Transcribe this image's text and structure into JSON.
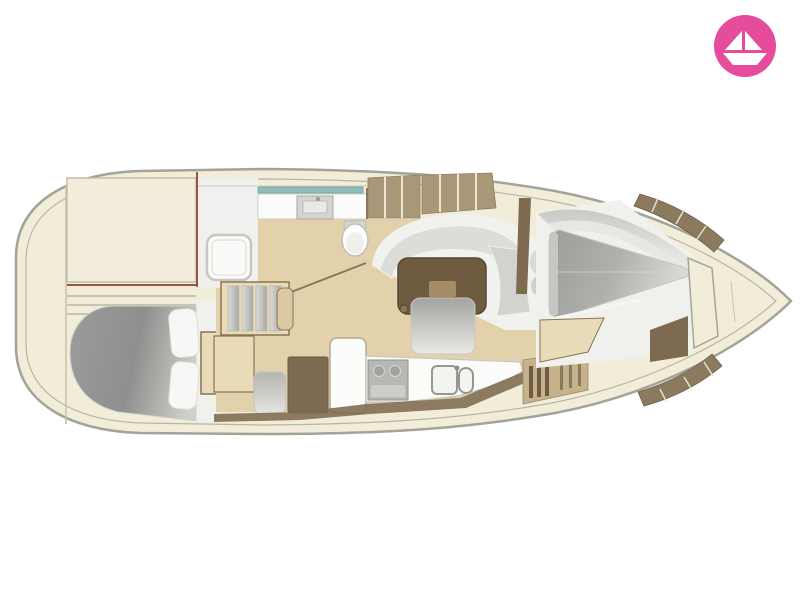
{
  "logo": {
    "icon": "paper-boat-icon",
    "background_color": "#e64c9c",
    "icon_color": "#ffffff"
  },
  "floor_plan": {
    "type": "sailboat-interior-top-view",
    "orientation": {
      "bow": "right",
      "stern": "left"
    },
    "areas": [
      "stern-deck",
      "aft-cabin-berth",
      "head-with-shower",
      "toilet",
      "companionway-steps",
      "salon-settee",
      "salon-table",
      "nav-station",
      "galley",
      "v-berth-cabin",
      "forepeak-anchor-locker"
    ],
    "colors": {
      "hull_fill": "#f2edd9",
      "hull_stroke": "#a3a39a",
      "deck_line": "#b9b5a3",
      "floor_beige": "#e2d1ab",
      "floor_white": "#f0f1ee",
      "cabinet_beige": "#e9dab8",
      "wood_brown": "#7d6a50",
      "trim_brown": "#8b7a5e",
      "locker_tan": "#a89878",
      "table_brown": "#6f5b40",
      "table_inlay": "#a38c66",
      "glass_teal": "#8fbdb9",
      "upholstery_light": "#dcdcd8",
      "counter_white": "#fbfbf9",
      "maroon_wall": "#9c5444",
      "logo_pink": "#e64c9c",
      "logo_icon": "#ffffff"
    }
  }
}
